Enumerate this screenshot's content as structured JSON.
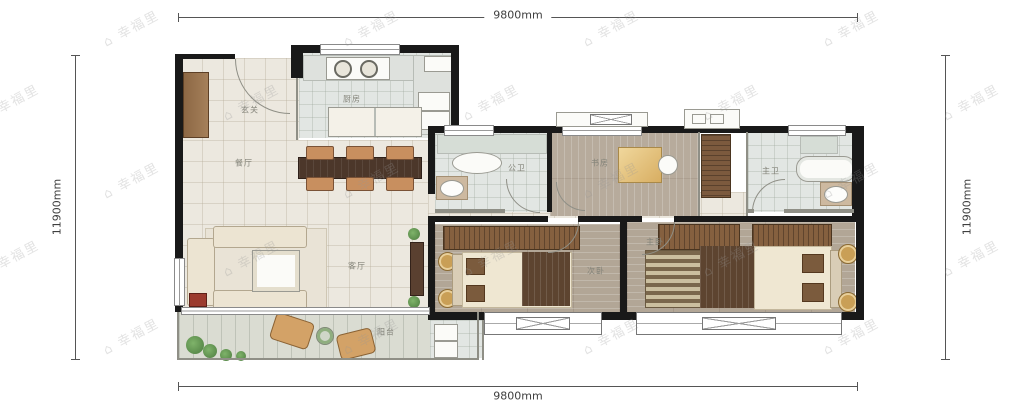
{
  "dimensions": {
    "top": "9800mm",
    "bottom": "9800mm",
    "left": "11900mm",
    "right": "11900mm"
  },
  "watermark": {
    "icon": "⌂",
    "text": "幸福里"
  },
  "rooms": {
    "entry": "玄关",
    "kitchen": "厨房",
    "dining": "餐厅",
    "living": "客厅",
    "balcony": "阳台",
    "bath": "公卫",
    "study": "书房",
    "master_bath": "主卫",
    "bedroom2": "次卧",
    "master_bedroom": "主卧"
  },
  "colors": {
    "wall": "#191919",
    "tile_floor": "#ece8df",
    "wood_floor": "#b2a696",
    "bath_floor": "#e2e6e3",
    "balcony_floor": "#dadcd2",
    "furniture_wood": "#85603f",
    "dim_line": "#555555"
  }
}
